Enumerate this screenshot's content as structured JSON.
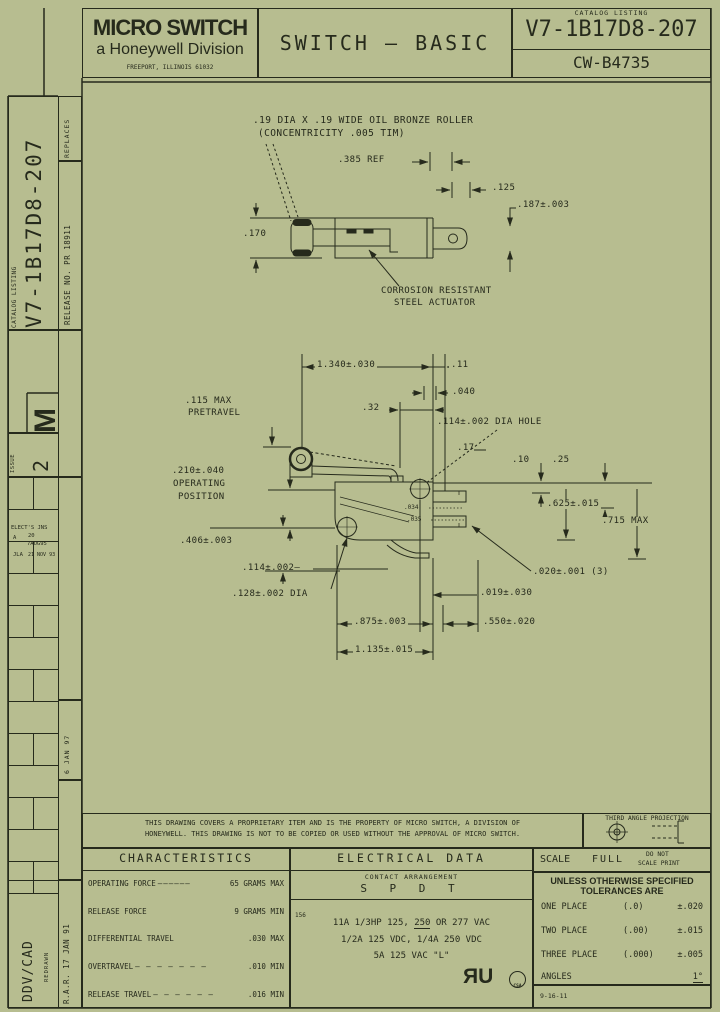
{
  "colors": {
    "paper": "#b7bd90",
    "ink": "#262a1c"
  },
  "header": {
    "logo_line1": "MICRO SWITCH",
    "logo_line2": "a Honeywell Division",
    "logo_line3": "FREEPORT, ILLINOIS 61032",
    "title": "SWITCH – BASIC",
    "catalog_label": "CATALOG LISTING",
    "catalog_number": "V7-1B17D8-207",
    "drawing_number": "CW-B4735"
  },
  "sidebar": {
    "replaces": "REPLACES",
    "release_no": "RELEASE NO.  PR 18911",
    "catalog_label": "CATALOG LISTING",
    "catalog_number": "V7-1B17D8-207",
    "rev_letter": "M",
    "issue_label": "ISSUE",
    "issue_value": "2",
    "rev1": "ELECT'S JNS",
    "rev2a": "A",
    "rev2b": "20",
    "rev2c": "7AUG95",
    "rev3a": "JLA",
    "rev3b": "21 NOV 93",
    "approval": "6 JAN 97",
    "drawn_sys": "DDV/CAD",
    "redrawn": "REDRAWN",
    "drawn_by": "R.A.R. 17 JAN 91"
  },
  "drawing": {
    "roller_note1": ".19 DIA X .19 WIDE OIL BRONZE ROLLER",
    "roller_note2": "(CONCENTRICITY .005 TIM)",
    "ref385": ".385 REF",
    "dim125": ".125",
    "dim187": ".187±.003",
    "dim170": ".170",
    "actuator1": "CORROSION RESISTANT",
    "actuator2": "STEEL ACTUATOR",
    "dim1340": "1.340±.030",
    "dim11": ".11",
    "dim040": ".040",
    "dim32": ".32",
    "pretravel1": ".115 MAX",
    "pretravel2": "PRETRAVEL",
    "hole_note": ".114±.002 DIA HOLE",
    "op1": ".210±.040",
    "op2": "OPERATING",
    "op3": "POSITION",
    "dim17": ".17",
    "dim10": ".10",
    "dim25": ".25",
    "dim625": ".625±.015",
    "dim715": ".715 MAX",
    "dim406": ".406±.003",
    "dim114": ".114±.002—",
    "dim128": ".128±.002 DIA",
    "dim020": ".020±.001 (3)",
    "dim019": ".019±.030",
    "dim875": ".875±.003",
    "dim550": ".550±.020",
    "dim1135": "1.135±.015",
    "term_no": ".034",
    "term_nc": ".035"
  },
  "notes": {
    "proprietary1": "THIS DRAWING COVERS A PROPRIETARY ITEM AND IS THE PROPERTY OF MICRO SWITCH, A DIVISION OF",
    "proprietary2": "HONEYWELL. THIS DRAWING IS NOT TO BE COPIED OR USED WITHOUT THE APPROVAL OF MICRO SWITCH.",
    "projection": "THIRD ANGLE PROJECTION"
  },
  "characteristics": {
    "title": "CHARACTERISTICS",
    "rows": [
      {
        "label": "OPERATING FORCE",
        "dashes": "——————",
        "value": "65 GRAMS MAX"
      },
      {
        "label": "RELEASE FORCE",
        "dashes": "",
        "value": "9 GRAMS MIN"
      },
      {
        "label": "DIFFERENTIAL TRAVEL",
        "dashes": "",
        "value": ".030 MAX"
      },
      {
        "label": "OVERTRAVEL",
        "dashes": "— — — — — — —",
        "value": ".010 MIN"
      },
      {
        "label": "RELEASE TRAVEL",
        "dashes": "— — — — — —",
        "value": ".016 MIN"
      }
    ]
  },
  "electrical": {
    "title": "ELECTRICAL DATA",
    "contact_label": "CONTACT ARRANGEMENT",
    "contact_value": "S P D T",
    "note_ref": "156",
    "rating1a": "11A 1/3HP 125, ",
    "rating1b": "250",
    "rating1c": " OR 277 VAC",
    "rating2": "1/2A 125 VDC, 1/4A 250 VDC",
    "rating3": "5A 125 VAC \"L\"",
    "ul_r": "R",
    "ul_u": "U",
    "csa": "CSA"
  },
  "title_block": {
    "scale_label": "SCALE",
    "scale_value": "FULL",
    "no_scale1": "DO NOT",
    "no_scale2": "SCALE PRINT",
    "tol_line1": "UNLESS OTHERWISE SPECIFIED",
    "tol_line2": "TOLERANCES ARE",
    "rows": [
      {
        "label": "ONE PLACE",
        "ref": "(.0)",
        "value": "±.020"
      },
      {
        "label": "TWO PLACE",
        "ref": "(.00)",
        "value": "±.015"
      },
      {
        "label": "THREE PLACE",
        "ref": "(.000)",
        "value": "±.005"
      },
      {
        "label": "ANGLES",
        "ref": "",
        "value": "1°"
      }
    ],
    "form_no": "9-16-11"
  }
}
